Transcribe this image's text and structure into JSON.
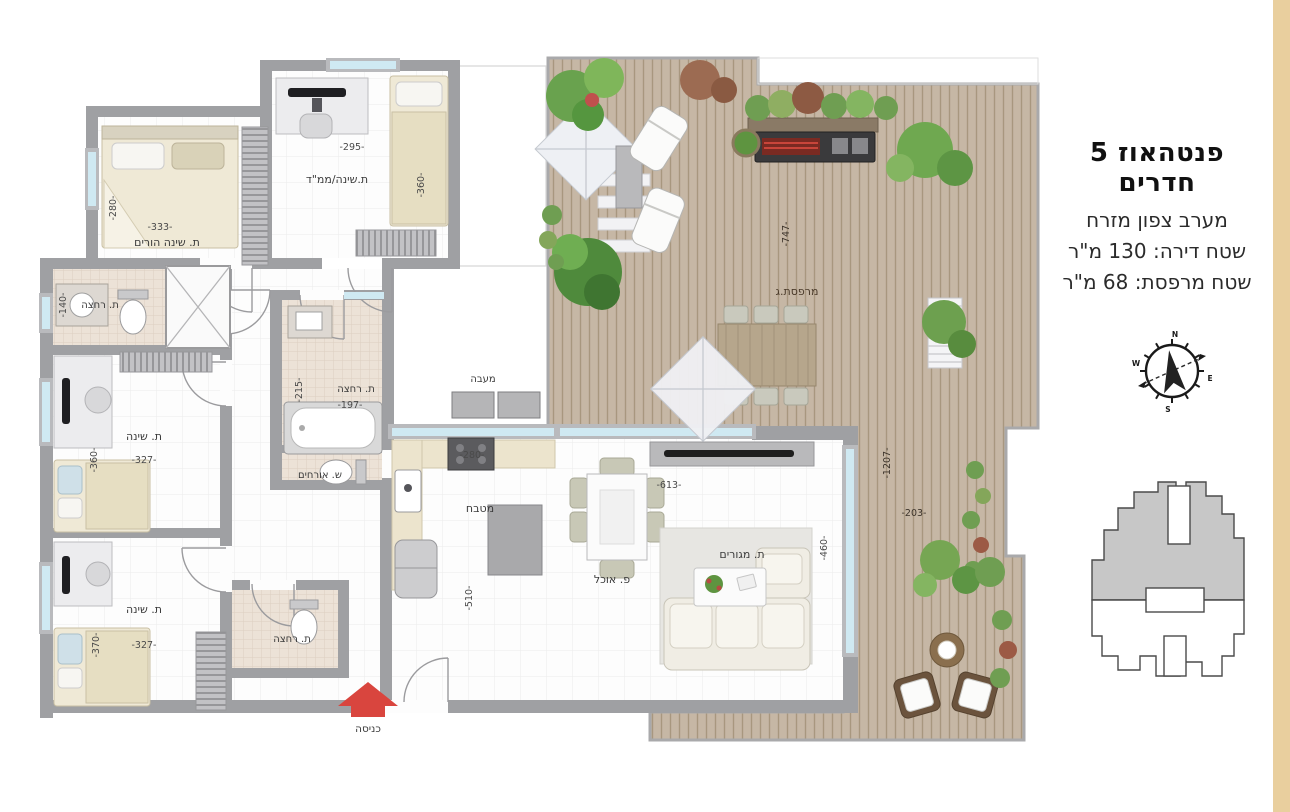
{
  "header": {
    "title": "פנטהאוז 5 חדרים",
    "orientation": "מערב צפון מזרח",
    "apartment_area": "שטח דירה: 130 מ\"ר",
    "balcony_area": "שטח מרפסת: 68 מ\"ר"
  },
  "plan": {
    "rooms": {
      "parents": {
        "name": "ת. שינה הורים",
        "w": "-333-",
        "d": "-280-"
      },
      "mamad": {
        "name": "ת.שינה/ממ\"ד",
        "w": "-295-",
        "d": "-360-"
      },
      "bath_top": {
        "name": "ת. רחצה",
        "d": "-140-"
      },
      "bed_mid": {
        "name": "ת. שינה",
        "w": "-327-",
        "d": "-360-"
      },
      "bed_bottom": {
        "name": "ת. שינה",
        "w": "-327-",
        "d": "-370-"
      },
      "bath_central": {
        "name": "ת. רחצה",
        "w": "-197-",
        "d": "-215-"
      },
      "guest_wc": {
        "name": "ש. אורחים"
      },
      "bath_entry": {
        "name": "ת. רחצה"
      },
      "kitchen": {
        "name": "מטבח",
        "w": "-280-",
        "d": "-510-"
      },
      "dining": {
        "name": "פ. אוכל",
        "w": "-613-"
      },
      "living": {
        "name": "ת. מגורים",
        "d": "-460-"
      },
      "terrace": {
        "name": "מרפסת.ג",
        "d": "-747-",
        "side_d": "-1207-",
        "side_w": "-203-"
      },
      "hvac": {
        "name": "מעבה"
      },
      "entrance": {
        "name": "כניסה"
      }
    }
  },
  "compass": {
    "n": "N",
    "e": "E",
    "s": "S",
    "w": "W"
  },
  "colors": {
    "wall": "#9fa0a3",
    "deck": "#c6b7a5",
    "accent_arrow": "#d9453e",
    "window": "#cfe9f2",
    "tile": "#ece2d7",
    "sidebar": "#e9cf9e",
    "keyplan_shade": "#c7c7c7"
  }
}
